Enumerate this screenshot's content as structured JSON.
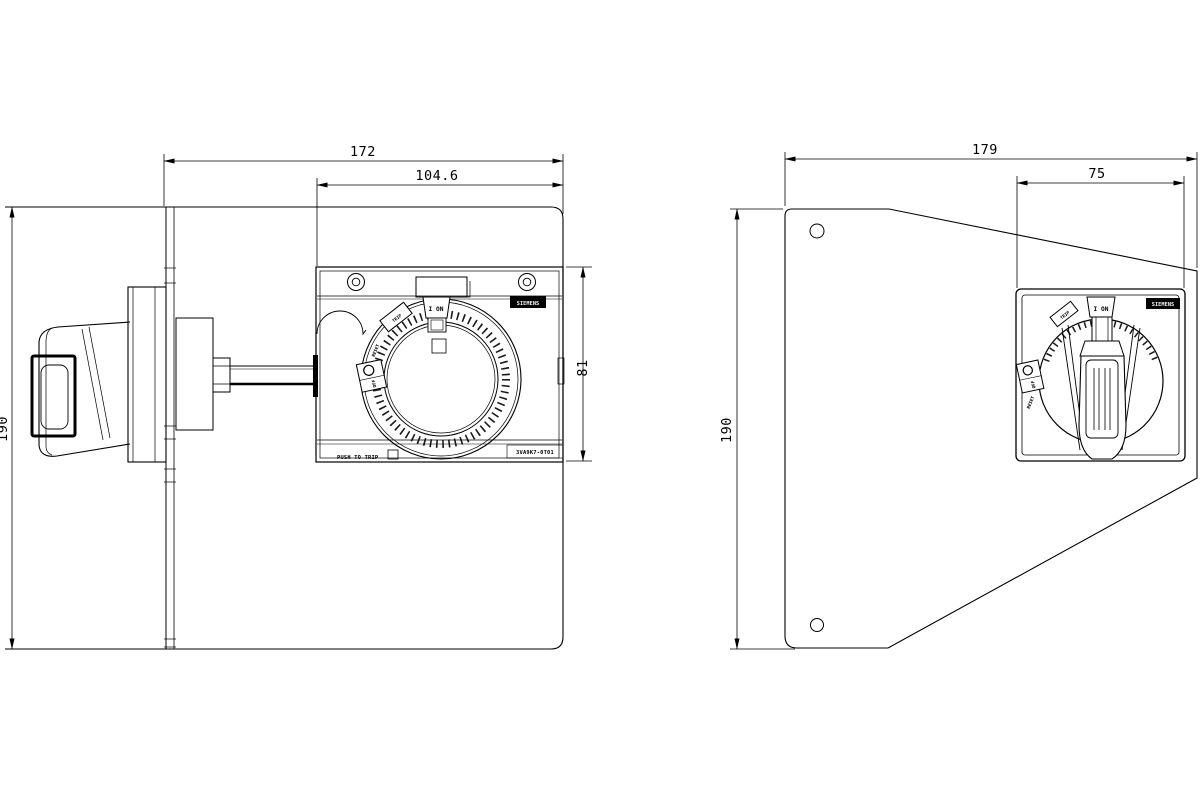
{
  "left_view": {
    "dim_total_width": "172",
    "dim_plate_width": "104.6",
    "dim_plate_height": "81",
    "dim_height": "190",
    "brand": "SIEMENS",
    "pos_on": "I ON",
    "pos_trip": "TRIP",
    "pos_off": "OFF",
    "pos_reset": "RESET",
    "push_to_trip": "PUSH TO TRIP",
    "part_number": "3VA9K7-0T01"
  },
  "right_view": {
    "dim_total_width": "179",
    "dim_plate_width": "75",
    "dim_height": "190",
    "brand": "SIEMENS",
    "pos_on": "I ON",
    "pos_trip": "TRIP",
    "pos_off": "OFF",
    "pos_reset": "RESET"
  }
}
